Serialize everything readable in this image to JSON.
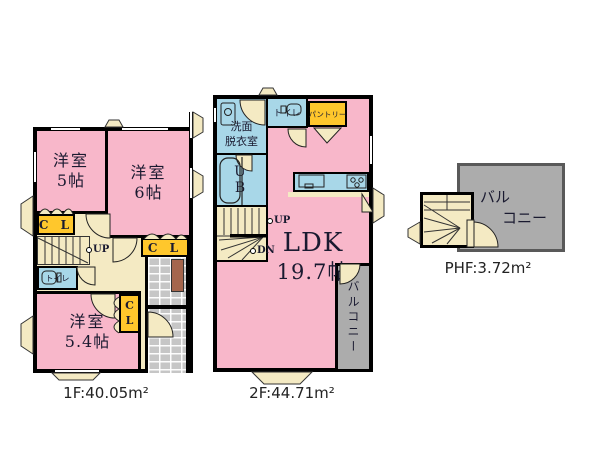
{
  "colors": {
    "room_pink": "#F8B7CA",
    "wet_area_blue": "#A8D7E8",
    "closet_yellow": "#FFC72C",
    "hallway_cream": "#F4EAC3",
    "balcony_gray": "#ACACAC",
    "entry_brick_gray": "#C6C6C6",
    "entry_door_brown": "#A5664D",
    "wall_black": "#000000"
  },
  "floor1": {
    "area_label": "1F:40.05m²",
    "room_5": {
      "name": "洋室",
      "size": "5帖"
    },
    "room_6": {
      "name": "洋室",
      "size": "6帖"
    },
    "room_54": {
      "name": "洋室",
      "size": "5.4帖"
    },
    "closet_label": "C L",
    "closet_c": "C",
    "closet_l": "L",
    "toilet_label": "トイレ",
    "stairs_up": "UP"
  },
  "floor2": {
    "area_label": "2F:44.71m²",
    "washroom_line1": "洗面",
    "washroom_line2": "脱衣室",
    "toilet_label": "トイレ",
    "pantry_label": "パントリー",
    "unit_bath_label": "U B",
    "ldk_name": "LDK",
    "ldk_size": "19.7帖",
    "balcony_label": "バルコニー",
    "stairs_up": "UP",
    "stairs_down": "DN"
  },
  "phf": {
    "area_label": "PHF:3.72m²",
    "balcony_line1": "バル",
    "balcony_line2": "コニー"
  }
}
